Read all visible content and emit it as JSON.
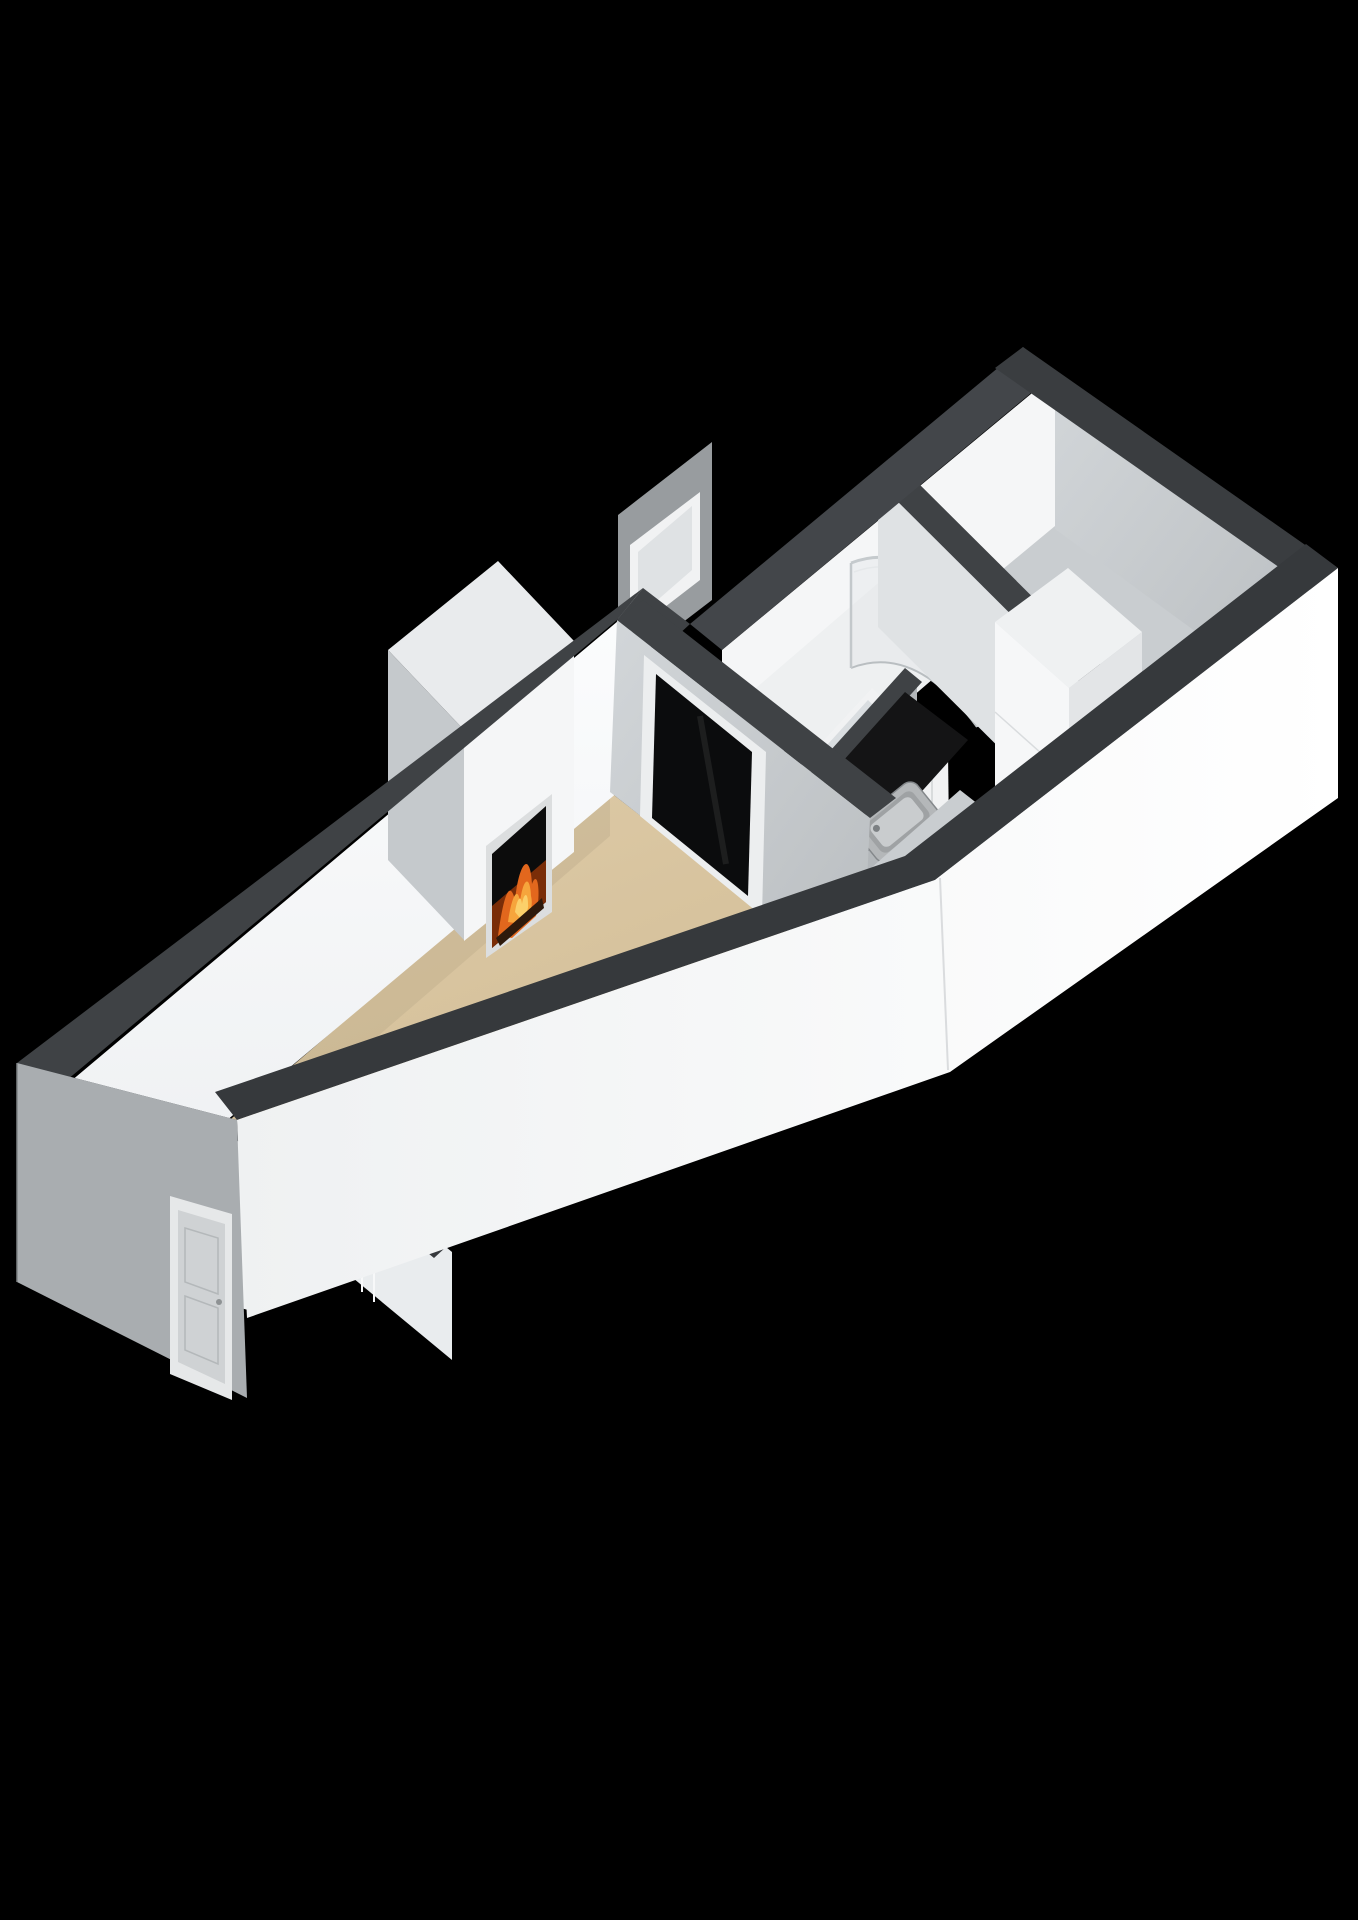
{
  "view": {
    "label": "3D floor plan dollhouse view",
    "background": "black",
    "orientation": "long axis lower-left to upper-right"
  },
  "colors": {
    "bg": "#000000",
    "wall_top": "#3f4245",
    "wall_top_dark": "#36393c",
    "face_bright": "#f5f6f7",
    "face_light": "#e8eaec",
    "face_mid": "#ccd0d3",
    "face_gray": "#b3b7ba",
    "face_ext": "#a9adb0",
    "floor_living": "#d9c6a1",
    "floor_room": "#c9cdd0",
    "floor_white": "#eef0f1",
    "kitchen_black": "#141415",
    "glass_dark": "#0b0c0d",
    "trim": "#f1f2f3",
    "se_wall": "#f7f9fa",
    "fire_ember": "#7a2d08",
    "fire_orange": "#e2671d",
    "fire_yellow": "#f6a53c",
    "fire_core": "#fbd06a",
    "sink_steel": "#b4b7b9",
    "shower_glass": "#c5cacd"
  },
  "rooms": {
    "living_room": {
      "label": "living room",
      "floor": "beige"
    },
    "entry_hall": {
      "label": "entry hall",
      "floor": "beige"
    },
    "kitchen": {
      "label": "kitchen",
      "floor": "black"
    },
    "bathroom": {
      "label": "bathroom",
      "floor": "white"
    },
    "bedroom": {
      "label": "bedroom",
      "floor": "gray"
    },
    "corridor": {
      "label": "corridor",
      "floor": "gray"
    }
  },
  "fixtures": {
    "fireplace": {
      "label": "fireplace with burning fire"
    },
    "shower": {
      "label": "curved glass shower enclosure with shower set"
    },
    "sink": {
      "label": "stainless steel kitchen sink in black counter"
    },
    "cabinet": {
      "label": "tall white kitchen cabinet"
    },
    "front_door": {
      "label": "front door"
    },
    "interior_door_kitchen": {
      "label": "white panel door to bathroom"
    },
    "interior_door_bedroom": {
      "label": "door to bedroom"
    },
    "window_sw": {
      "label": "window on south-west wall"
    },
    "window_dark": {
      "label": "dark glazed window"
    },
    "window_kitchen": {
      "label": "window above sink"
    },
    "window_slit": {
      "label": "narrow slit window"
    },
    "window_bathroom": {
      "label": "bathroom window"
    }
  }
}
